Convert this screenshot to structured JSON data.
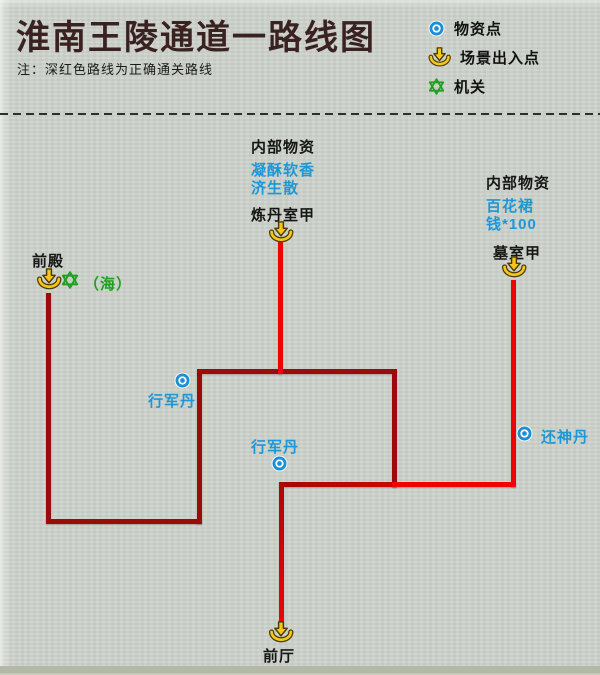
{
  "title": "淮南王陵通道一路线图",
  "note": "注：深红色路线为正确通关路线",
  "legend": {
    "items": [
      {
        "icon": "supply-point-icon",
        "label": "物资点"
      },
      {
        "icon": "scene-exit-icon",
        "label": "场景出入点"
      },
      {
        "icon": "mechanism-icon",
        "label": "机关"
      }
    ]
  },
  "colors": {
    "correct_route_dark_red": "#9c0b0b",
    "other_route_red": "#ee0404",
    "supply_point_blue": "#1e97d6",
    "scene_exit_yellow": "#f5c71a",
    "mechanism_green": "#1fa01f",
    "background_paper": "#cdd2cb"
  },
  "map": {
    "areas": {
      "front_hall_top": {
        "label": "前殿",
        "mechanism_note": "（海）"
      },
      "alchemy_room": {
        "header": "内部物资",
        "items": [
          "凝酥软香",
          "济生散"
        ],
        "label": "炼丹室甲"
      },
      "tomb_room": {
        "header": "内部物资",
        "items": [
          "百花裙",
          "钱*100"
        ],
        "label": "墓室甲"
      },
      "front_hall_bottom": {
        "label": "前厅"
      }
    },
    "supply_points": [
      {
        "label": "行军丹"
      },
      {
        "label": "行军丹"
      },
      {
        "label": "还神丹"
      }
    ]
  }
}
